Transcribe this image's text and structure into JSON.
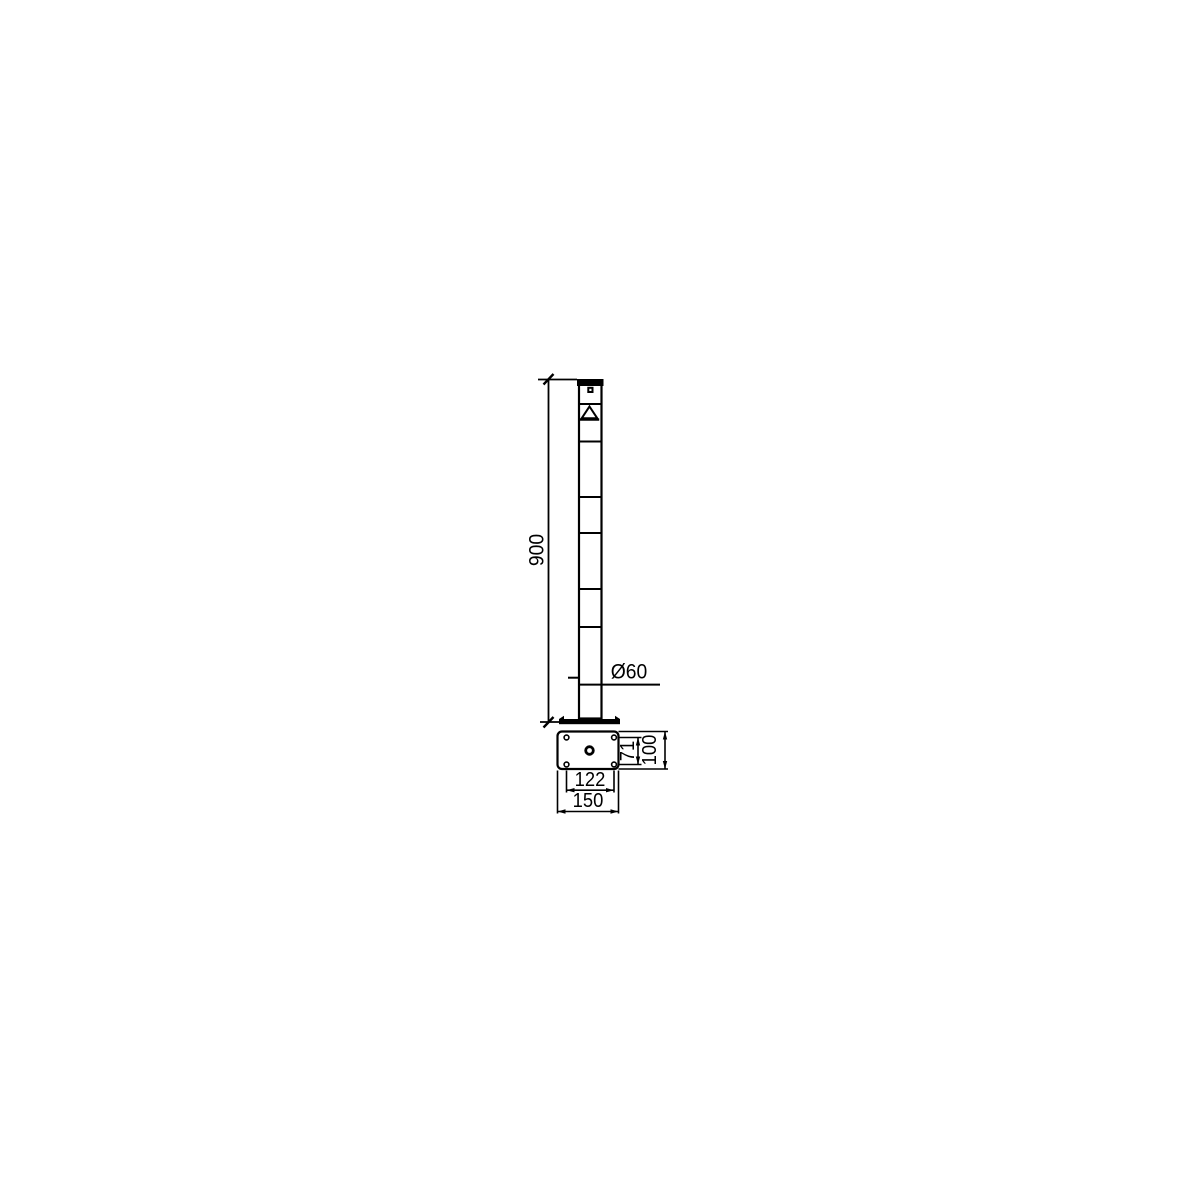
{
  "drawing": {
    "kind": "technical-dimension-drawing",
    "colors": {
      "background": "#ffffff",
      "line": "#000000"
    },
    "front_view": {
      "label": "bollard-front-view",
      "dimensions": {
        "height": "900",
        "post_diameter": "Ø60"
      },
      "symbols": [
        "cap",
        "lock-dot",
        "triangle-marker",
        "stripe-lines",
        "base-flange"
      ]
    },
    "top_view": {
      "label": "base-plate-top-view",
      "dimensions": {
        "bolt_hole_spacing_depth": "71",
        "plate_depth": "100",
        "bolt_hole_spacing_width": "122",
        "plate_width": "150"
      },
      "features": [
        "four-bolt-holes",
        "center-hole"
      ]
    }
  }
}
